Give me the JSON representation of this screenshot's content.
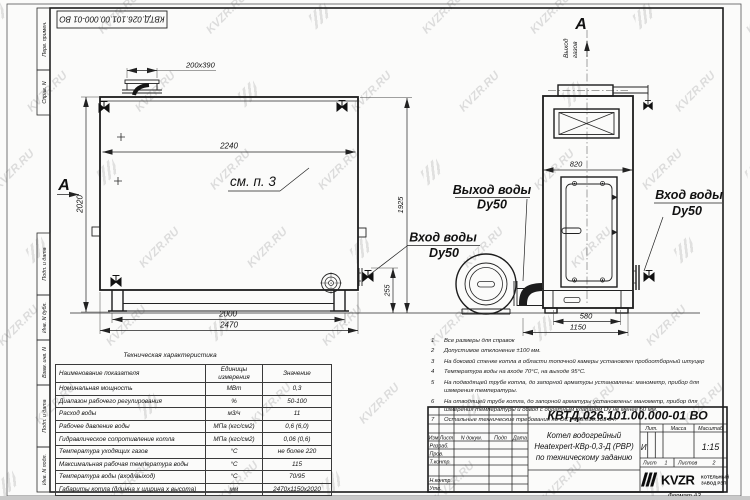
{
  "watermark": {
    "text": "KVZR.RU",
    "color": "#c4c4c4"
  },
  "stamp_top": "КВТД.026.101.00.000-01 ВО",
  "margin_labels": [
    "Перв. примен.",
    "Справ. N",
    "Подп. и дата",
    "Инв. N дубл.",
    "Взам. инв. N",
    "Подп. и дата",
    "Инв. N подл."
  ],
  "main_view": {
    "section_label": "А",
    "see_note": "см. п. 3",
    "dims": {
      "stub": "200х390",
      "width_inner": "2240",
      "height": "2020",
      "base": "2000",
      "overall": "2470",
      "inlet_height": "255",
      "total_height": "1925"
    }
  },
  "front_view": {
    "section_label": "А",
    "gas_out_line1": "Выход",
    "gas_out_line2": "газов",
    "dims": {
      "width": "820",
      "door": "580",
      "overall": "1150"
    }
  },
  "labels": {
    "water_out": "Выход воды",
    "water_out_dn": "Dy50",
    "water_in_right": "Вход воды",
    "water_in_right_dn": "Dy50",
    "water_in_left": "Вход воды",
    "water_in_left_dn": "Dy50"
  },
  "notes": {
    "items": [
      {
        "num": "1",
        "text": "Все размеры для справок"
      },
      {
        "num": "2",
        "text": "Допустимое отклонение ±100 мм."
      },
      {
        "num": "3",
        "text": "На боковой стенке котла в области топочной камеры установлен пробоотборный штуцер"
      },
      {
        "num": "4",
        "text": "Температура воды на входе 70°С, на выходе 95°С."
      },
      {
        "num": "5",
        "text": "На подводящей трубе котла, до запорной арматуры установлены: манометр, прибор для измерения температуры."
      },
      {
        "num": "6",
        "text": "На отводящей трубе котла, до запорной арматуры установлены: манометр, прибор для измерения температуры и обвод с обратным клапаном Dу не менее 50 мм."
      },
      {
        "num": "7",
        "text": "Остальные технические требования по ОСТ 108.030.133-84."
      }
    ]
  },
  "table": {
    "title": "Техническая характеристика",
    "headers": [
      "Наименование показателя",
      "Единицы измерения",
      "Значение"
    ],
    "rows": [
      [
        "Номинальная мощность",
        "МВт",
        "0,3"
      ],
      [
        "Диапазон рабочего регулирования",
        "%",
        "50-100"
      ],
      [
        "Расход воды",
        "м3/ч",
        "11"
      ],
      [
        "Рабочее давление воды",
        "МПа (кгс/см2)",
        "0,6 (6,0)"
      ],
      [
        "Гидравлическое сопротивление котла",
        "МПа (кгс/см2)",
        "0,06 (0,6)"
      ],
      [
        "Температура уходящих газов",
        "°С",
        "не более 220"
      ],
      [
        "Максимальная рабочая температура воды",
        "°С",
        "115"
      ],
      [
        "Температура воды (вход/выход)",
        "°С",
        "70/95"
      ],
      [
        "Габариты котла (длинна х ширина х высота)",
        "мм",
        "2470х1150х2020"
      ]
    ]
  },
  "title_block": {
    "doc_number": "КВТД.026.101.00.000-01 ВО",
    "rev_headers": [
      "Изм",
      "Лист",
      "N докум.",
      "Подп",
      "Дата"
    ],
    "row_labels": [
      "Разраб.",
      "Пров.",
      "Т.контр.",
      "Н.контр.",
      "Утв."
    ],
    "title_line1": "Котел водогрейный",
    "title_line2": "Heatexpert-КВр-0,3-Д (РВР)",
    "title_line3": "по техническому заданию",
    "lit_header": "Лит.",
    "lit_value": "И",
    "mass_header": "Масса",
    "scale_header": "Масштаб",
    "scale_value": "1:15",
    "sheet_label": "Лист",
    "sheet_value": "1",
    "sheets_label": "Листов",
    "sheets_value": "2",
    "logo_text": "KVZR",
    "logo_sub1": "КОТЕЛЬНЫЙ",
    "logo_sub2": "ЗАВОД РЭП",
    "format_label": "Формат  А3"
  }
}
